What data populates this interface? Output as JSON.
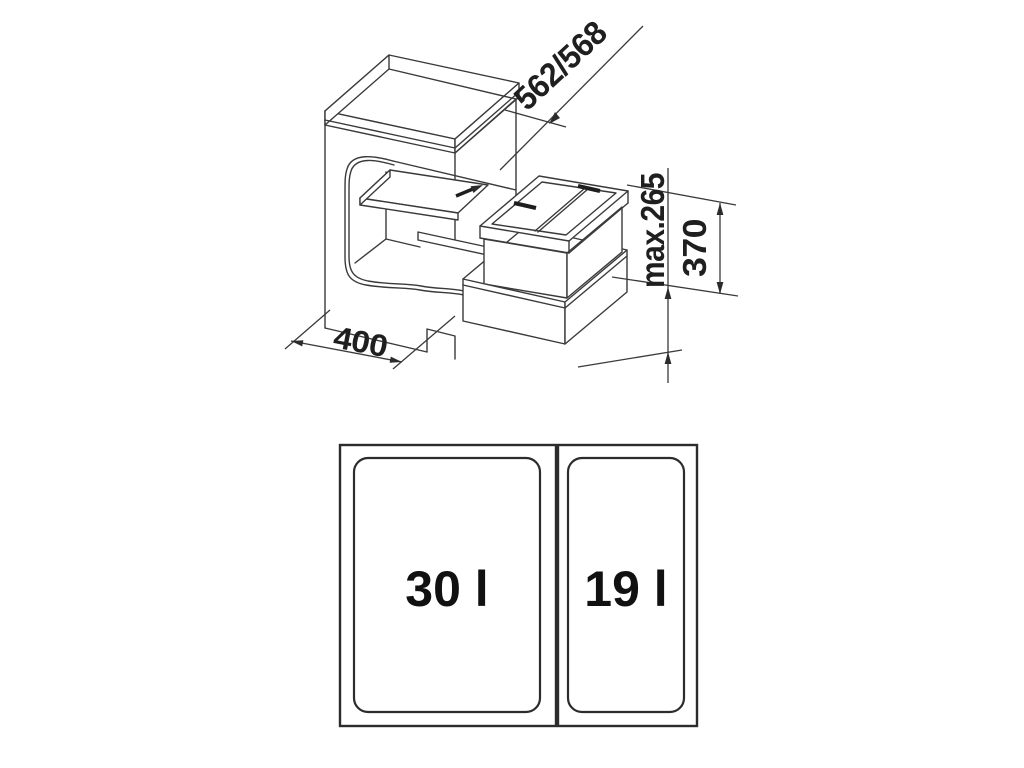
{
  "figure": {
    "type": "technical-drawing",
    "description": "Isometric cabinet drawing with pull-out waste bin system and top view of bins",
    "line_color": "#3a3a3a",
    "text_color": "#1f1f1f",
    "background": "#ffffff"
  },
  "iso_view": {
    "dimensions": {
      "depth_label": "562/568",
      "max_height_label": "max.265",
      "height_label": "370",
      "width_label": "400"
    },
    "icons": {
      "slide_direction": "arrow-right-up"
    }
  },
  "top_view": {
    "bins": [
      {
        "capacity_label": "30 l"
      },
      {
        "capacity_label": "19 l"
      }
    ]
  }
}
